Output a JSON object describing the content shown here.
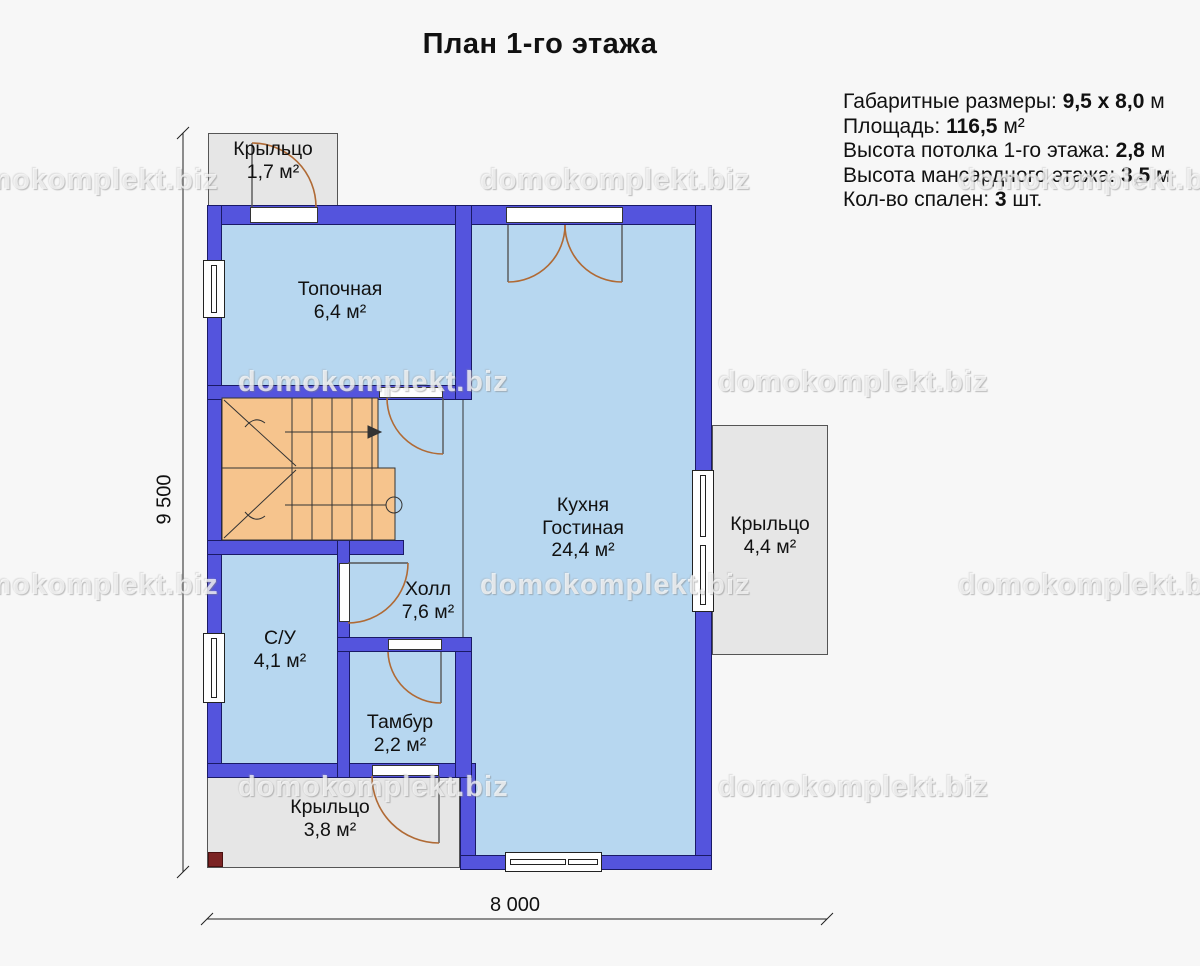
{
  "title": "План 1-го этажа",
  "watermark": {
    "text": "domokomplekt.biz"
  },
  "info": {
    "lines": [
      {
        "label": "Габаритные размеры: ",
        "value": "9,5 x 8,0",
        "suffix": " м"
      },
      {
        "label": "Площадь: ",
        "value": "116,5",
        "suffix": " м²"
      },
      {
        "label": "Высота потолка 1-го этажа: ",
        "value": "2,8",
        "suffix": " м"
      },
      {
        "label": "Высота мансардного этажа: ",
        "value": "3,5",
        "suffix": " м"
      },
      {
        "label": "Кол-во спален: ",
        "value": "3",
        "suffix": " шт."
      }
    ]
  },
  "rooms": [
    {
      "name": "Крыльцо",
      "area": "1,7 м²"
    },
    {
      "name": "Топочная",
      "area": "6,4 м²"
    },
    {
      "name": "Кухня\nГостиная",
      "area": "24,4 м²"
    },
    {
      "name": "Холл",
      "area": "7,6 м²"
    },
    {
      "name": "С/У",
      "area": "4,1 м²"
    },
    {
      "name": "Тамбур",
      "area": "2,2 м²"
    },
    {
      "name": "Крыльцо",
      "area": "4,4 м²"
    },
    {
      "name": "Крыльцо",
      "area": "3,8 м²"
    }
  ],
  "dimensions": {
    "width": "8 000",
    "height": "9 500"
  },
  "colors": {
    "wall": "#5454dd",
    "room_fill": "#b7d7f0",
    "stairs": "#f6c48d",
    "porch": "#e6e6e6",
    "door_arc": "#b06a35",
    "background": "#f7f7f7"
  }
}
